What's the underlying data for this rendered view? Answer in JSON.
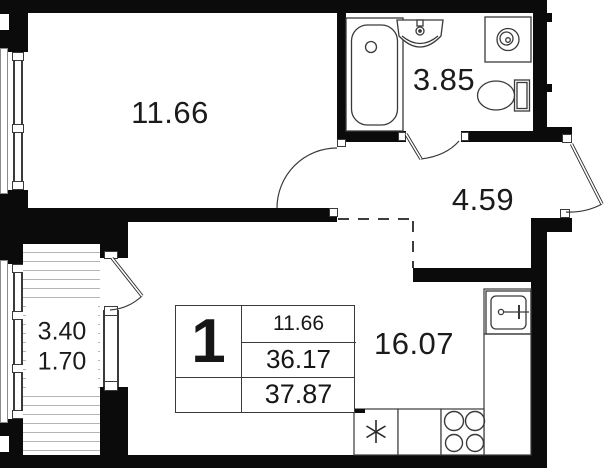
{
  "plan": {
    "rooms": {
      "bedroom": {
        "area": "11.66"
      },
      "bathroom": {
        "area": "3.85"
      },
      "hallway": {
        "area": "4.59"
      },
      "kitchen_living": {
        "area": "16.07"
      },
      "balcony": {
        "area_full": "3.40",
        "area_reduced": "1.70"
      }
    },
    "legend": {
      "rooms_count": "1",
      "living_area": "11.66",
      "area_without_balcony": "36.17",
      "total_area": "37.87"
    },
    "colors": {
      "wall": "#0b0b0b",
      "line": "#3a3a3a",
      "text": "#1b1b1b"
    },
    "icons": [
      "bathtub-icon",
      "bath-sink-icon",
      "washing-machine-icon",
      "toilet-icon",
      "kitchen-sink-icon",
      "stove-icon",
      "fridge-snowflake-icon",
      "door-swing-icon"
    ]
  }
}
